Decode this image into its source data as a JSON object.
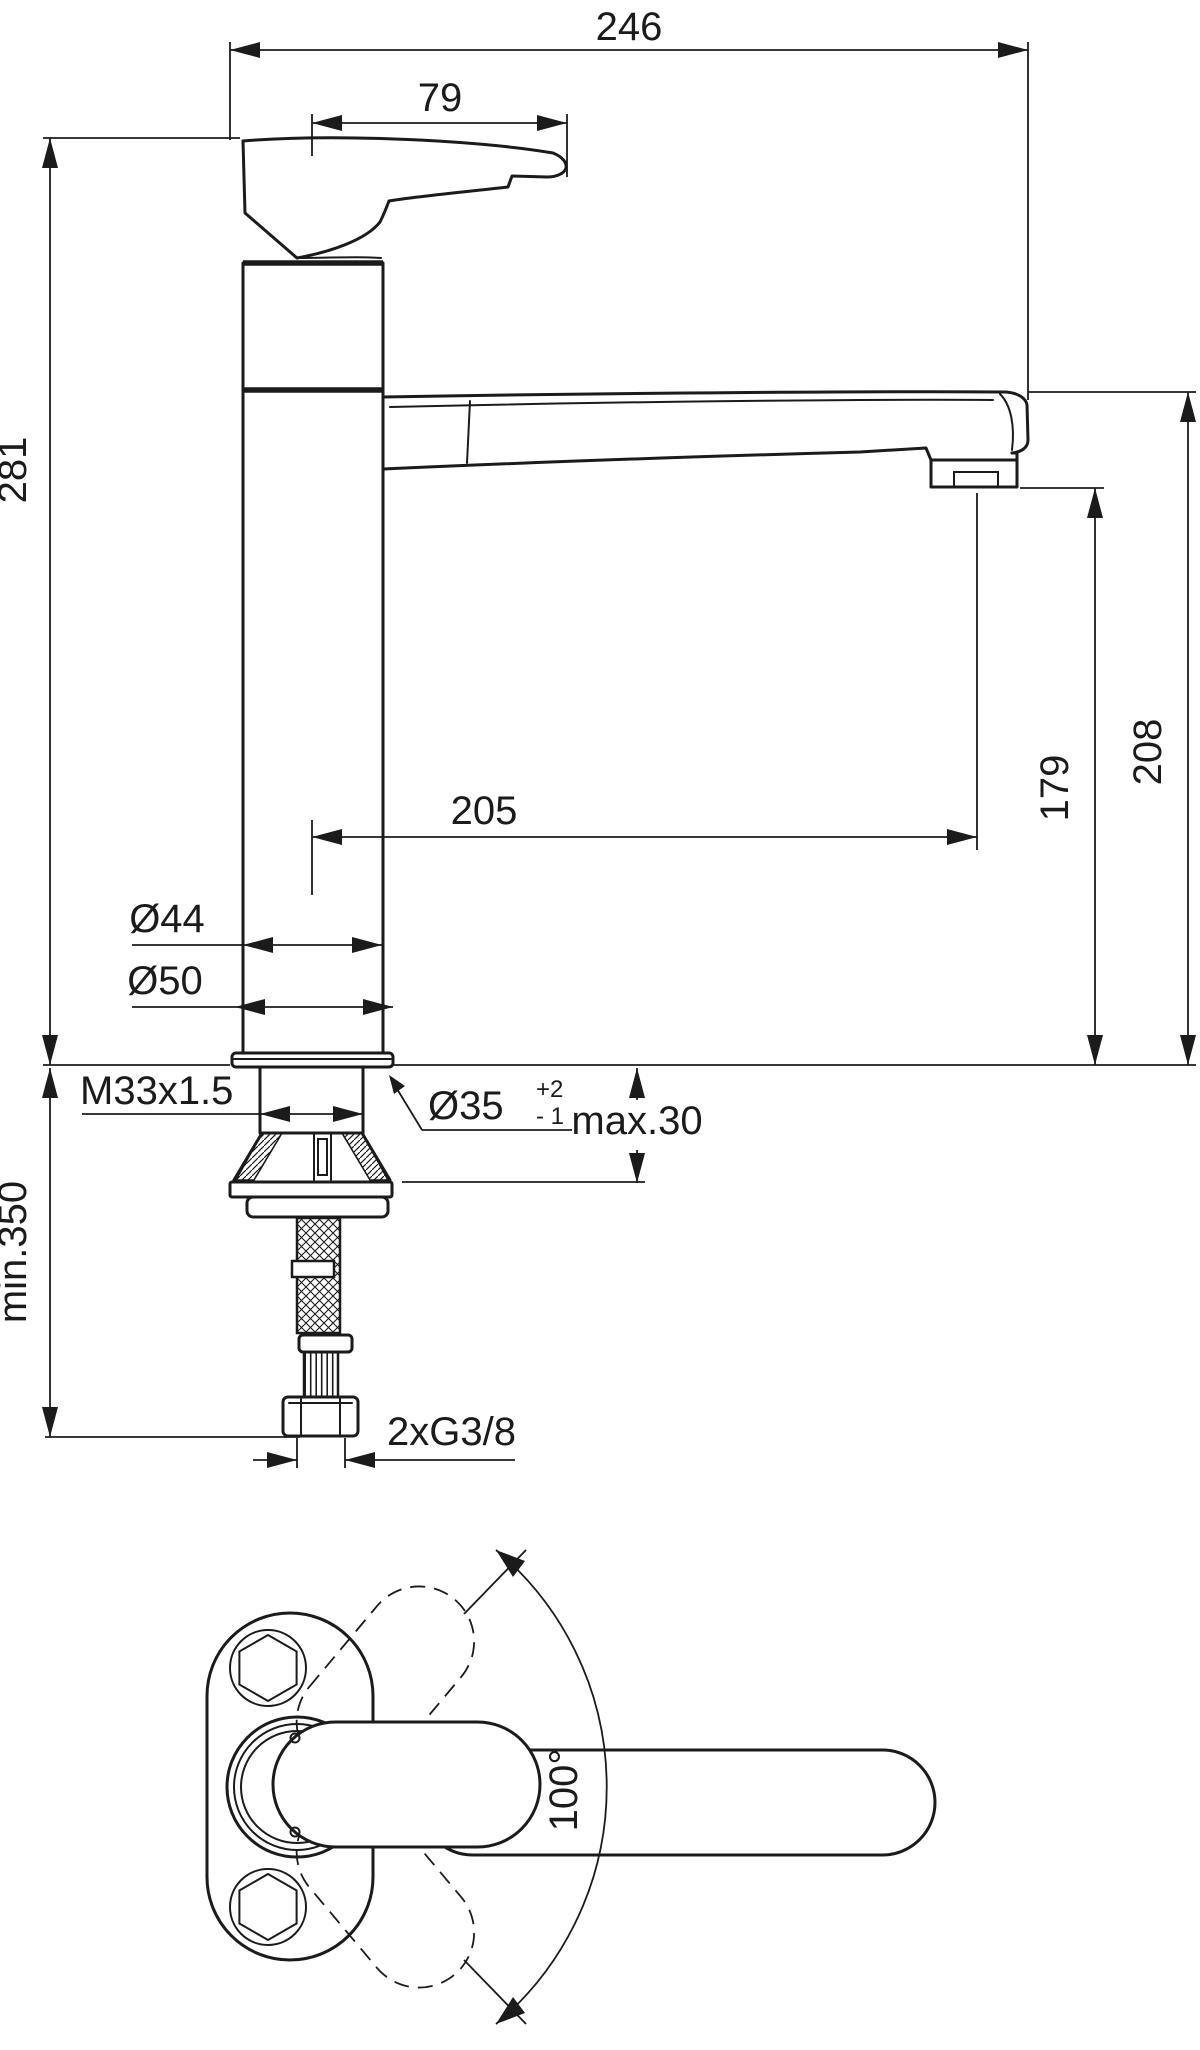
{
  "drawing": {
    "type": "technical-dimension-drawing",
    "views": [
      "side-elevation-of-single-lever-kitchen-faucet",
      "plan-view-with-swivel-range"
    ],
    "labels": {
      "overall_length": "246",
      "handle_length": "79",
      "body_height": "281",
      "spout_reach": "205",
      "aerator_height": "179",
      "spout_height": "208",
      "body_diameter": "Ø44",
      "base_diameter": "Ø50",
      "thread_spec": "M33x1.5",
      "hole_diameter": "Ø35",
      "hole_tolerance_plus": "+2",
      "hole_tolerance_minus": "- 1",
      "deck_thickness": "max.30",
      "min_clearance": "min.350",
      "supply_connection": "2xG3/8",
      "swivel_angle": "100°"
    },
    "colors": {
      "line": "#1b1b1b",
      "background": "#ffffff"
    }
  }
}
